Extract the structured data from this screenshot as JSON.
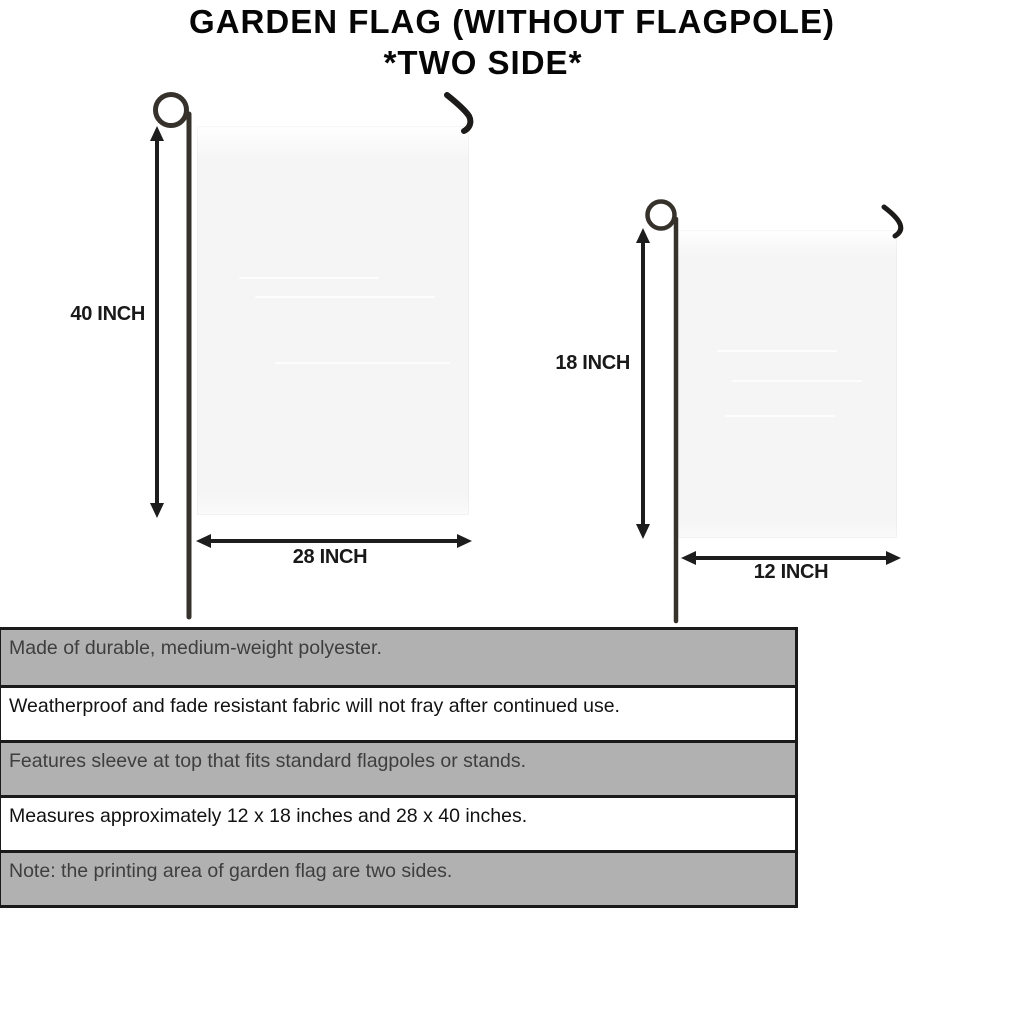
{
  "title": {
    "line1": "GARDEN FLAG (WITHOUT FLAGPOLE)",
    "line2": "*TWO SIDE*"
  },
  "diagram": {
    "large_flag": {
      "height_label": "40 INCH",
      "width_label": "28 INCH"
    },
    "small_flag": {
      "height_label": "18 INCH",
      "width_label": "12 INCH"
    }
  },
  "features": [
    {
      "text": "Made of durable, medium-weight polyester."
    },
    {
      "text": "Weatherproof and fade resistant fabric will not fray after continued use."
    },
    {
      "text": "Features sleeve at top that fits standard flagpoles or stands."
    },
    {
      "text": "Measures approximately 12 x 18 inches and 28 x 40 inches."
    },
    {
      "text": "Note: the printing area of garden flag are two sides."
    }
  ],
  "colors": {
    "shaded_row_background": "#b1b1b1",
    "plain_row_background": "#ffffff",
    "table_border": "#1a1a1a",
    "pole": "#36322b",
    "arrow": "#1d1d1d",
    "flag_fill": "#f5f5f6",
    "title_text": "#060606"
  }
}
